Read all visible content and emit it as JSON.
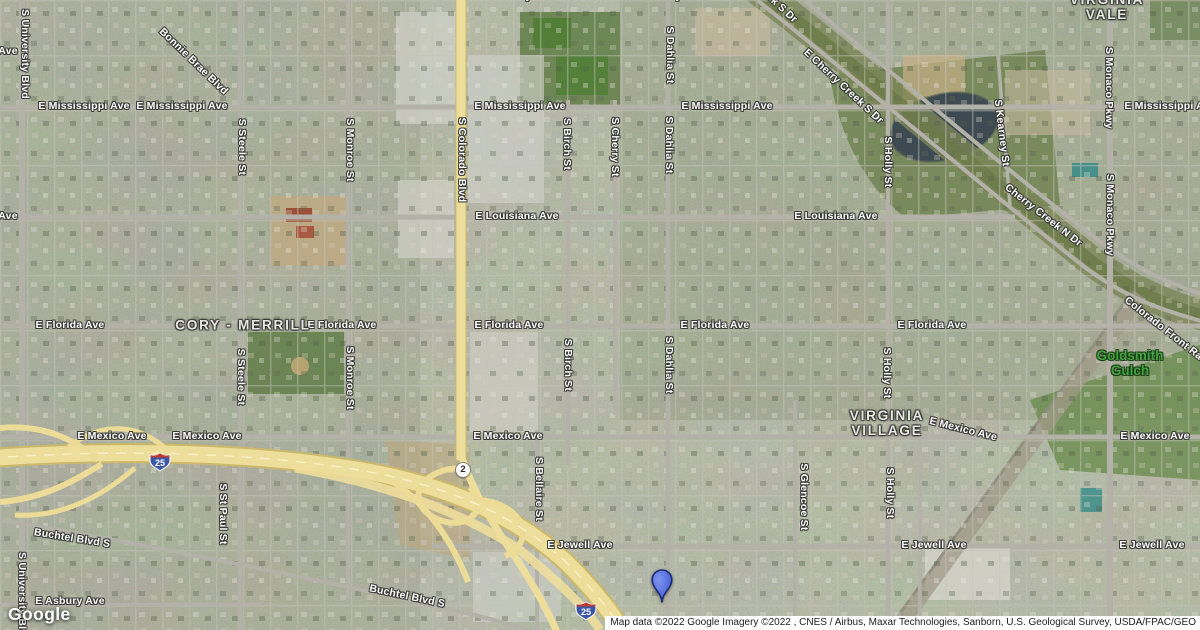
{
  "map": {
    "labels": [
      {
        "t": "E Mississippi Ave",
        "x": 84,
        "y": 107
      },
      {
        "t": "E Mississippi Ave",
        "x": 182,
        "y": 107
      },
      {
        "t": "E Mississippi Ave",
        "x": 520,
        "y": 107
      },
      {
        "t": "E Mississippi Ave",
        "x": 727,
        "y": 107
      },
      {
        "t": "E Mississippi Ave",
        "x": 1170,
        "y": 107
      },
      {
        "t": "E Kentucky Ave",
        "x": 513,
        "y": -3
      },
      {
        "t": "E Kentucky Ave",
        "x": 663,
        "y": -3
      },
      {
        "t": "E Louisiana Ave",
        "x": 517,
        "y": 217
      },
      {
        "t": "E Louisiana Ave",
        "x": 836,
        "y": 217
      },
      {
        "t": "Ave",
        "x": 8,
        "y": 217
      },
      {
        "t": "Ave",
        "x": 8,
        "y": 52
      },
      {
        "t": "E Florida Ave",
        "x": 70,
        "y": 326
      },
      {
        "t": "E Florida Ave",
        "x": 342,
        "y": 326
      },
      {
        "t": "E Florida Ave",
        "x": 509,
        "y": 326
      },
      {
        "t": "E Florida Ave",
        "x": 715,
        "y": 326
      },
      {
        "t": "E Florida Ave",
        "x": 932,
        "y": 326
      },
      {
        "t": "E Mexico Ave",
        "x": 112,
        "y": 437
      },
      {
        "t": "E Mexico Ave",
        "x": 207,
        "y": 437
      },
      {
        "t": "E Mexico Ave",
        "x": 508,
        "y": 437
      },
      {
        "t": "E Mexico Ave",
        "x": 963,
        "y": 430,
        "r": 14
      },
      {
        "t": "E Mexico Ave",
        "x": 1155,
        "y": 437
      },
      {
        "t": "E Jewell Ave",
        "x": 580,
        "y": 546
      },
      {
        "t": "E Jewell Ave",
        "x": 934,
        "y": 546
      },
      {
        "t": "E Jewell Ave",
        "x": 1152,
        "y": 546
      },
      {
        "t": "E Asbury Ave",
        "x": 70,
        "y": 602
      },
      {
        "t": "Buchtel Blvd S",
        "x": 72,
        "y": 539,
        "r": 9
      },
      {
        "t": "Buchtel Blvd S",
        "x": 407,
        "y": 597,
        "r": 12
      },
      {
        "t": "Bonnie Brae Blvd",
        "x": 193,
        "y": 62,
        "r": 44
      },
      {
        "t": "E Cherry Creek S Dr",
        "x": 843,
        "y": 87,
        "r": 43
      },
      {
        "t": "E Cherry Creek S Dr",
        "x": 757,
        "y": -14,
        "r": 43
      },
      {
        "t": "Cherry Creek N Dr",
        "x": 1043,
        "y": 216,
        "r": 38
      },
      {
        "t": "Colorado Front Ra",
        "x": 1163,
        "y": 329,
        "r": 38
      },
      {
        "t": "S University Blvd",
        "x": 24,
        "y": 54,
        "k": "roadv"
      },
      {
        "t": "S University Blvd",
        "x": 21,
        "y": 597,
        "k": "roadv"
      },
      {
        "t": "S Steele St",
        "x": 241,
        "y": 147,
        "k": "roadv"
      },
      {
        "t": "S Steele St",
        "x": 240,
        "y": 377,
        "k": "roadv"
      },
      {
        "t": "S Monroe St",
        "x": 349,
        "y": 150,
        "k": "roadv"
      },
      {
        "t": "S Monroe St",
        "x": 349,
        "y": 378,
        "k": "roadv"
      },
      {
        "t": "S Colorado Blvd",
        "x": 461,
        "y": 160,
        "k": "roadv"
      },
      {
        "t": "S Birch St",
        "x": 566,
        "y": 144,
        "k": "roadv"
      },
      {
        "t": "S Birch St",
        "x": 567,
        "y": 365,
        "k": "roadv"
      },
      {
        "t": "S Cherry St",
        "x": 614,
        "y": 147,
        "k": "roadv"
      },
      {
        "t": "S Dahlia St",
        "x": 669,
        "y": 55,
        "k": "roadv"
      },
      {
        "t": "S Dahlia St",
        "x": 668,
        "y": 145,
        "k": "roadv"
      },
      {
        "t": "S Dahlia St",
        "x": 668,
        "y": 365,
        "k": "roadv"
      },
      {
        "t": "S Holly St",
        "x": 887,
        "y": 162,
        "k": "roadv"
      },
      {
        "t": "S Holly St",
        "x": 886,
        "y": 373,
        "k": "roadv"
      },
      {
        "t": "S Holly St",
        "x": 889,
        "y": 493,
        "k": "roadv"
      },
      {
        "t": "S Glencoe St",
        "x": 803,
        "y": 497,
        "k": "roadv"
      },
      {
        "t": "S Kearney St",
        "x": 1001,
        "y": 133,
        "k": "roadv",
        "r": 83
      },
      {
        "t": "S Monaco Pkwy",
        "x": 1108,
        "y": 88,
        "k": "roadv"
      },
      {
        "t": "S Monaco Pkwy",
        "x": 1109,
        "y": 215,
        "k": "roadv"
      },
      {
        "t": "S St Paul St",
        "x": 222,
        "y": 514,
        "k": "roadv"
      },
      {
        "t": "S Bellaire St",
        "x": 538,
        "y": 489,
        "k": "roadv"
      },
      {
        "t": "CORY - MERRILL",
        "x": 243,
        "y": 326,
        "k": "hood"
      },
      {
        "t": "VIRGINIA VALE",
        "x": 1107,
        "y": 8,
        "k": "hood"
      },
      {
        "t": "VIRGINIA\nVILLAGE",
        "x": 887,
        "y": 424,
        "k": "hood"
      },
      {
        "t": "Goldsmith\nGulch",
        "x": 1130,
        "y": 364,
        "k": "gulch"
      }
    ],
    "shields": [
      {
        "kind": "interstate",
        "label": "25",
        "x": 160,
        "y": 464
      },
      {
        "kind": "interstate",
        "label": "25",
        "x": 586,
        "y": 613
      },
      {
        "kind": "state",
        "label": "2",
        "x": 463,
        "y": 470
      }
    ],
    "marker": {
      "x": 662,
      "y": 602
    },
    "colors": {
      "highway": "#eede9b",
      "arterial": "#b3b1a8",
      "park": "#5c7a42",
      "water": "#3e4a52",
      "marker_blue": "#4a67e3",
      "gulch_label_green": "#46a23e"
    }
  },
  "branding": {
    "logo_text": "Google"
  },
  "attribution": {
    "text": "Map data ©2022 Google Imagery ©2022 , CNES / Airbus, Maxar Technologies, Sanborn, U.S. Geological Survey, USDA/FPAC/GEO"
  }
}
